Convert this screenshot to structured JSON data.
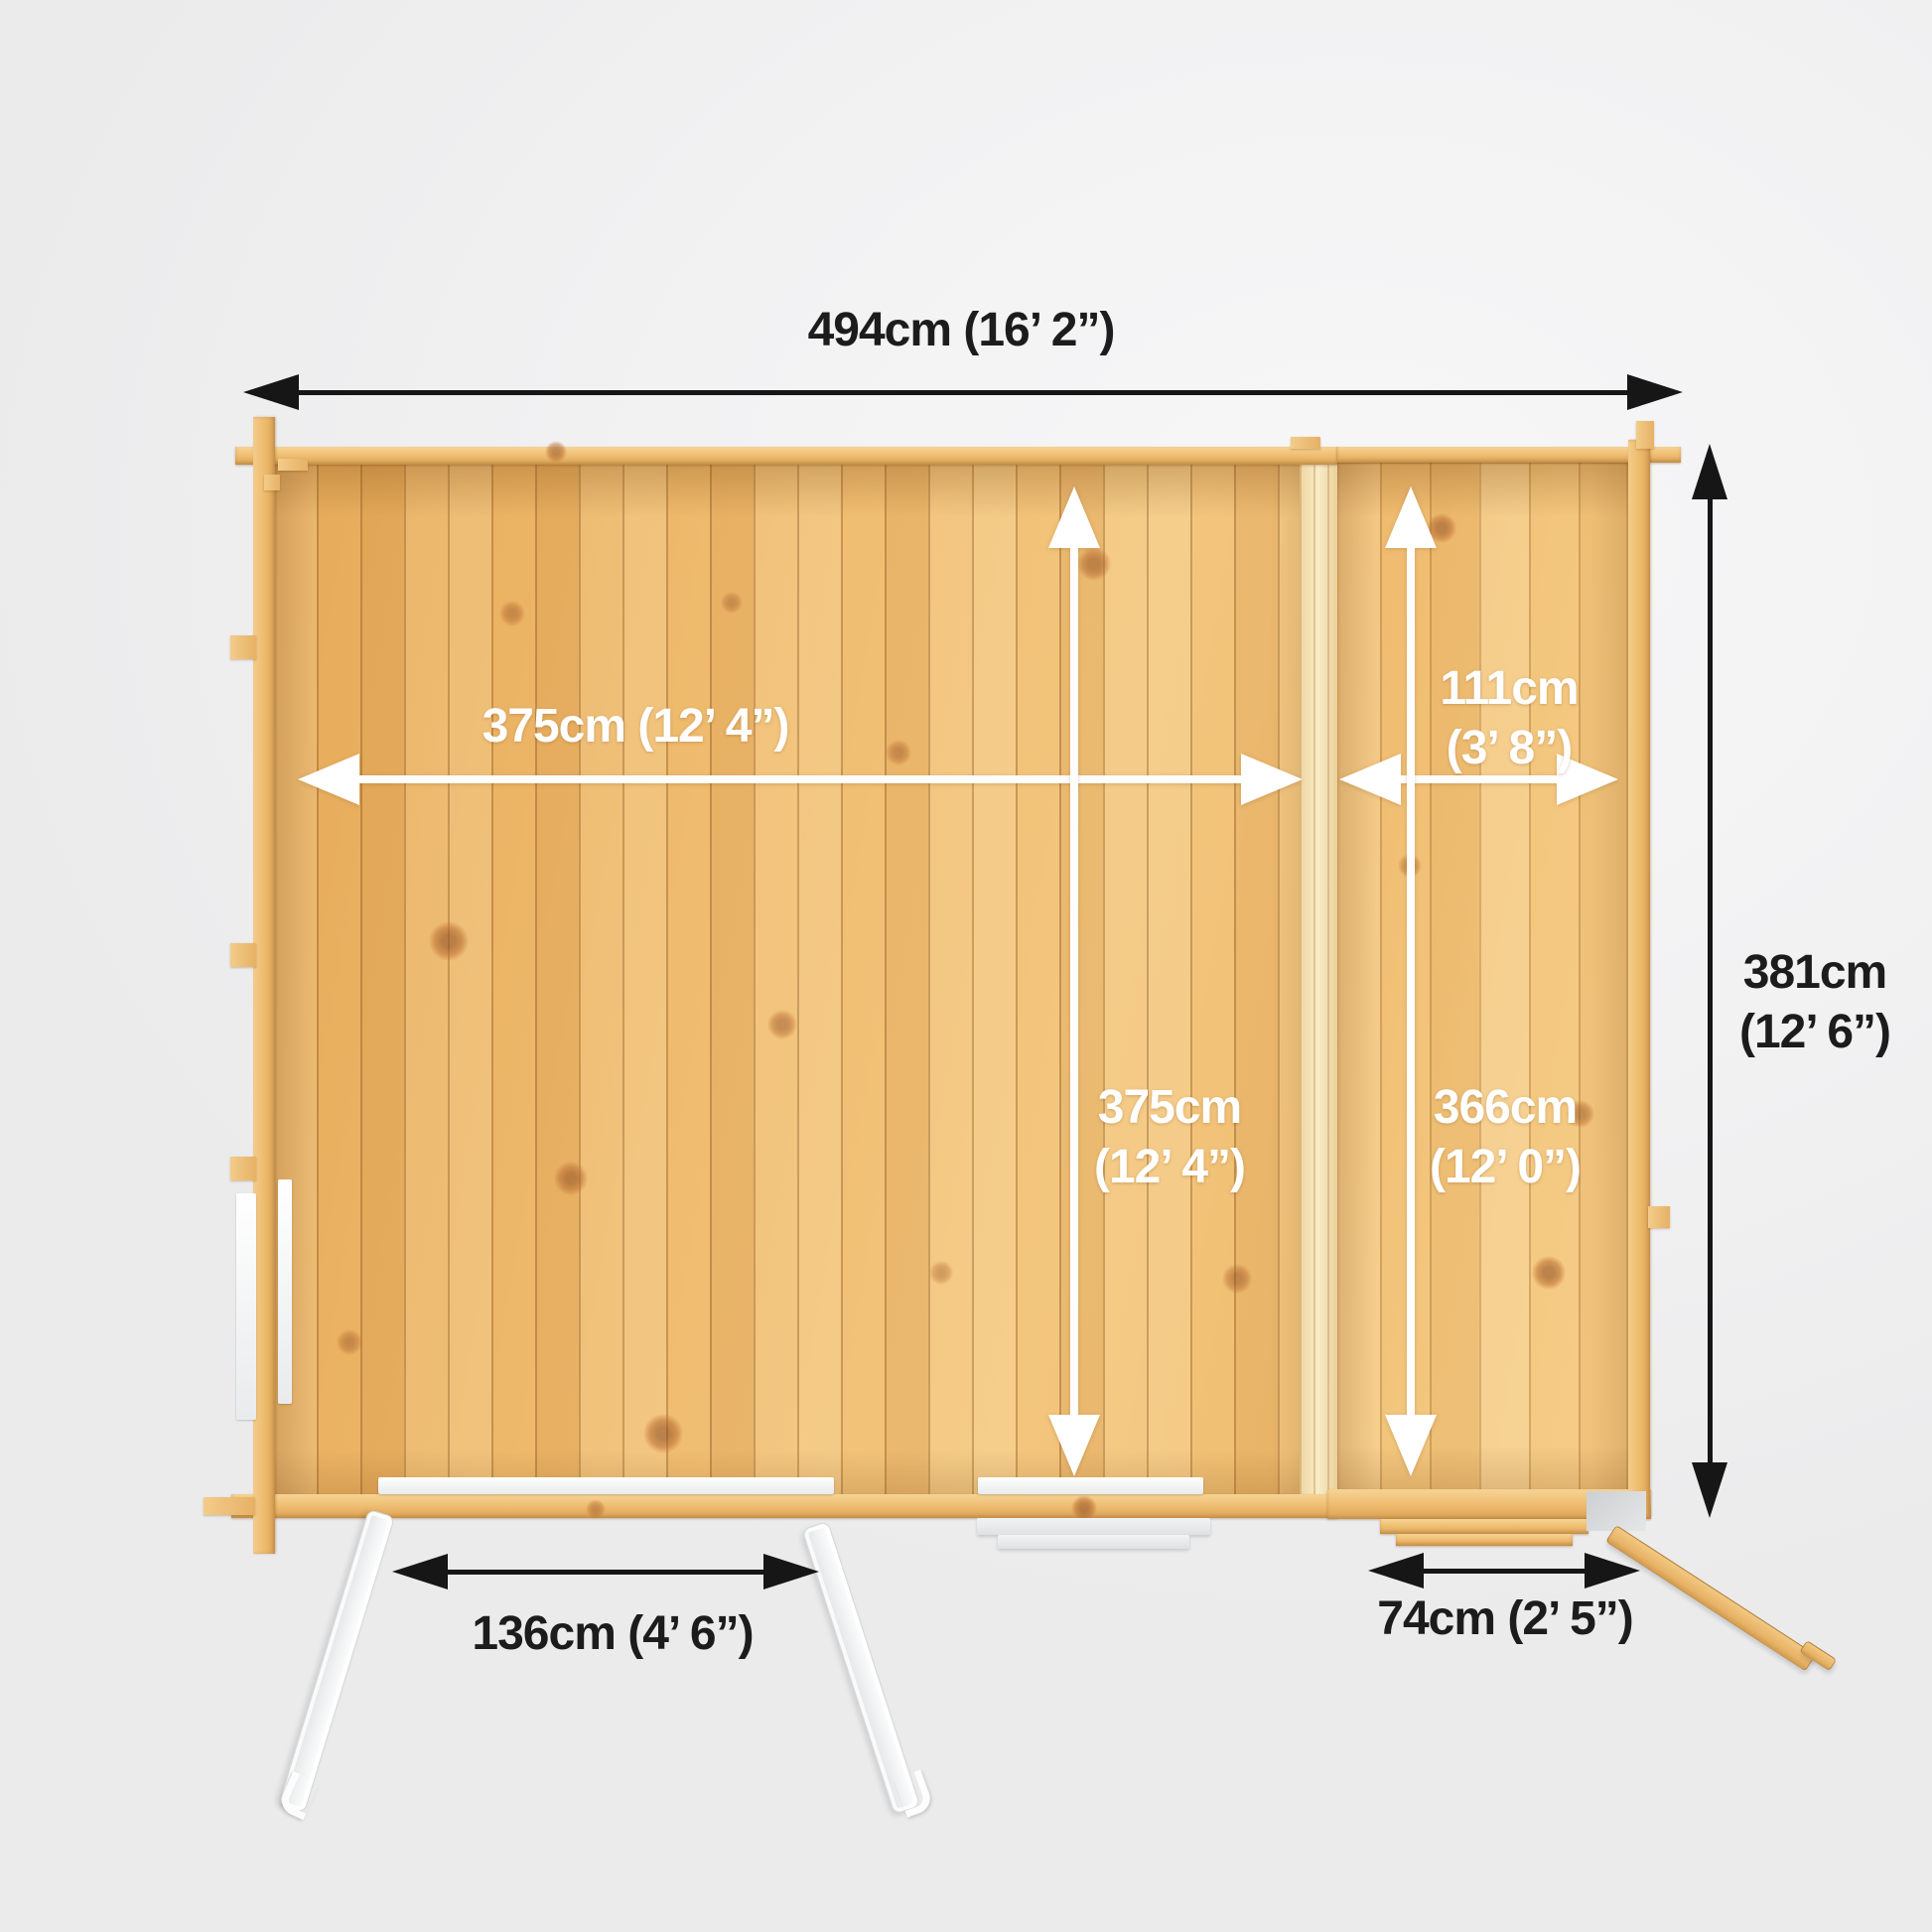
{
  "diagram": {
    "type": "log-cabin-floorplan-top-view",
    "colors": {
      "background": "#f2f2f3",
      "wood_floor": "#efbb6e",
      "wood_light": "#f3c67e",
      "wood_log": "#eebb6e",
      "dimension_black": "#161616",
      "dimension_white": "#ffffff",
      "door_white": "#f0f1f2"
    }
  },
  "dimensions": {
    "overall_width": "494cm (16’ 2”)",
    "overall_depth": [
      "381cm",
      "(12’ 6”)"
    ],
    "main_width": "375cm (12’ 4”)",
    "main_depth": [
      "375cm",
      "(12’ 4”)"
    ],
    "annex_width": [
      "111cm",
      "(3’ 8”)"
    ],
    "annex_depth": [
      "366cm",
      "(12’ 0”)"
    ],
    "main_door_width": "136cm (4’ 6”)",
    "annex_door_width": "74cm (2’ 5”)"
  }
}
